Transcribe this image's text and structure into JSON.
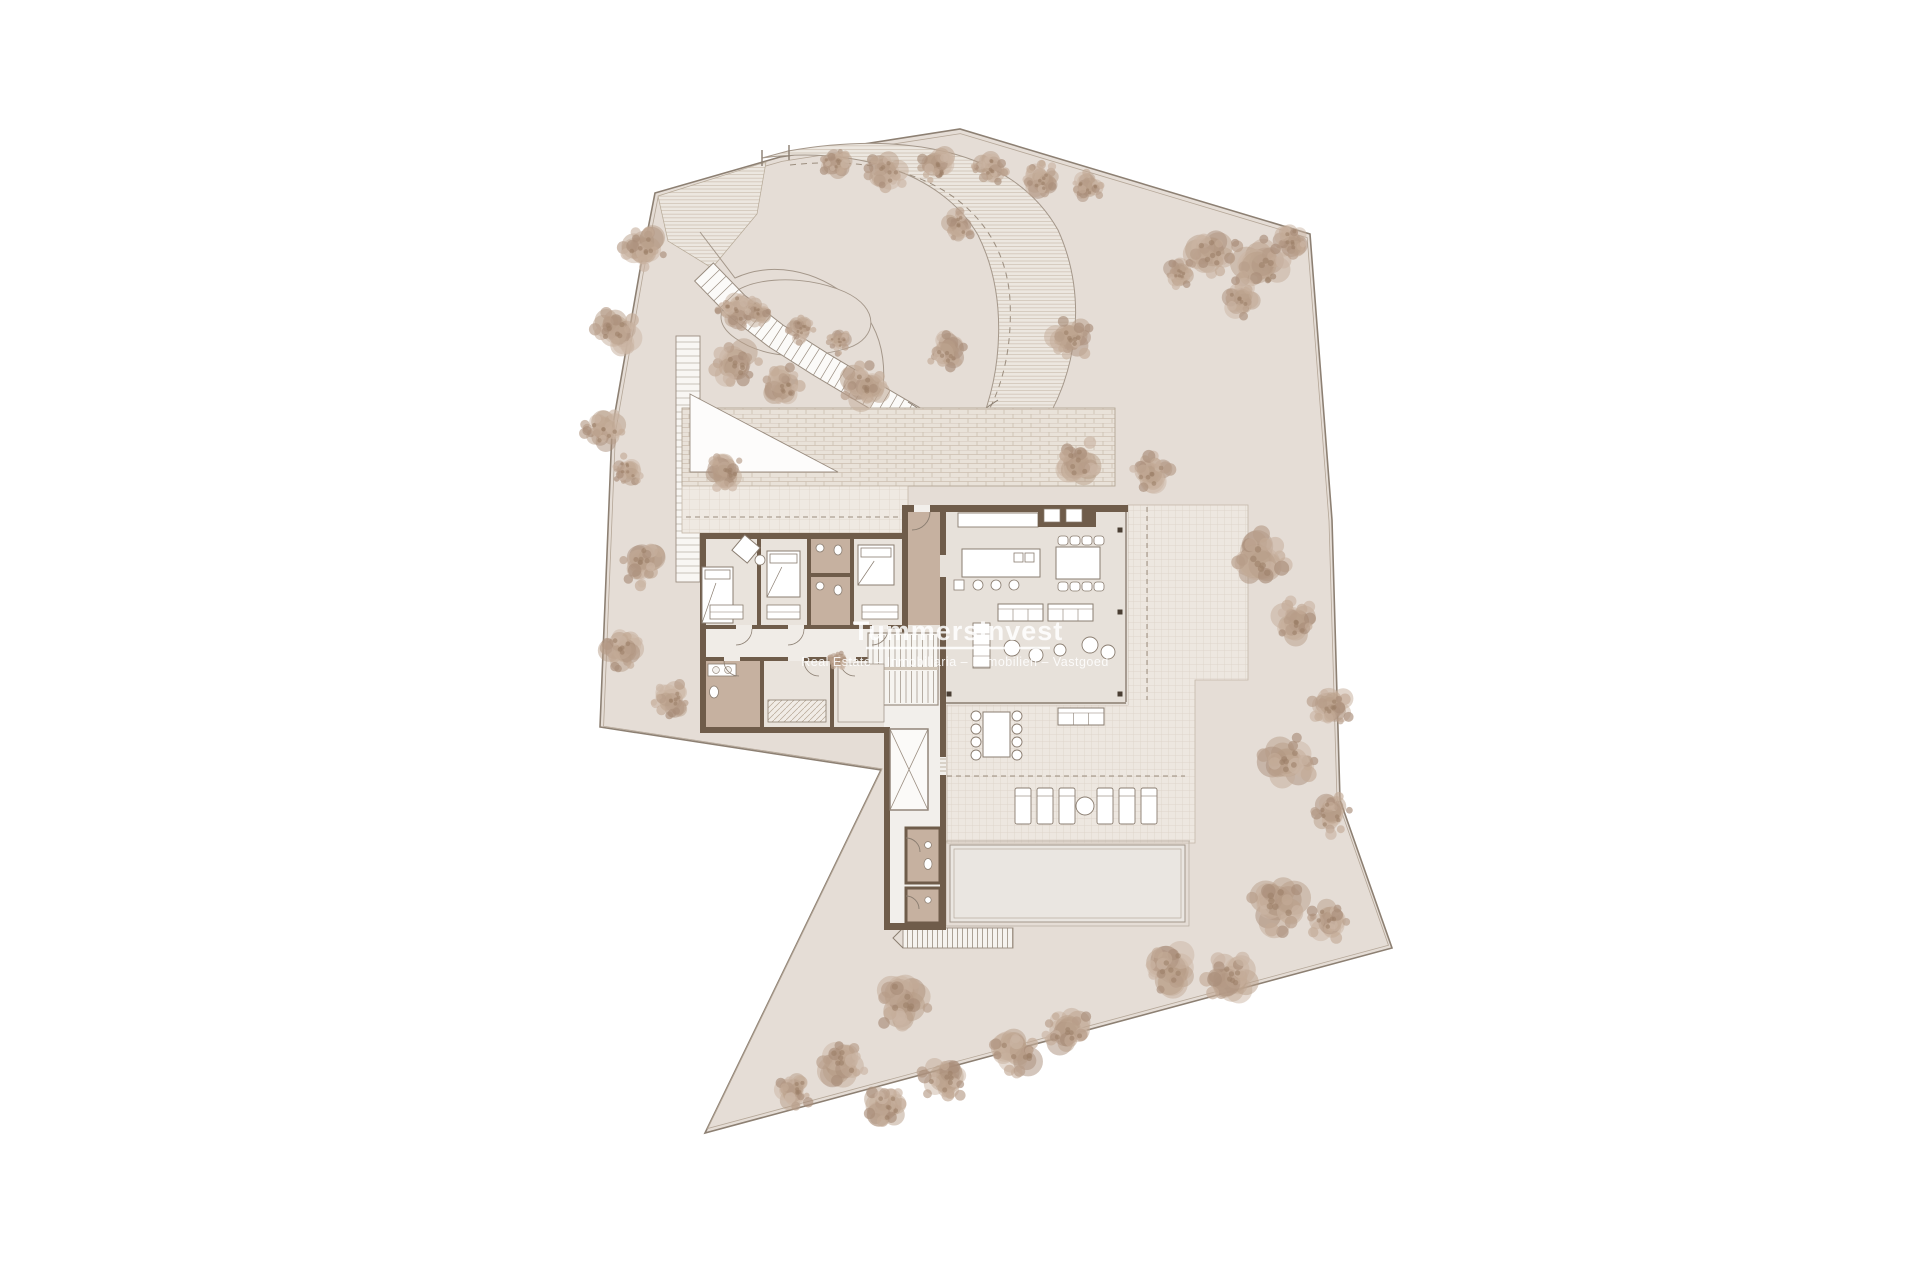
{
  "watermark": {
    "brand": "TummersInvest",
    "tagline": "Real Estate – Inmobiliaria – Immobilien – Vastgoed"
  },
  "drawing": {
    "kind": "architectural site plan / villa floor plan",
    "features": [
      "plot boundary",
      "curved driveway",
      "garden trees",
      "bedroom wing",
      "living-kitchen pavilion",
      "terrace",
      "sun loungers",
      "swimming pool",
      "staircase",
      "elevator"
    ]
  },
  "palette": {
    "paper": "#ffffff",
    "plot": "#e5ddd6",
    "plot_line": "#8d8073",
    "wall": "#6f5c4a",
    "bath_floor": "#c6b1a0",
    "room_floor": "#e9e3dc",
    "living_floor": "#e7e1da",
    "tile": "#ede7e0",
    "tile_line": "#d9cfc4",
    "brick": "#e9e2d9",
    "brick_line": "#ccbfb0",
    "hatch_fill": "#ece7e0",
    "hatch_line": "#d2c7ba",
    "pool": "#eae6e1",
    "pool_line": "#a2968a",
    "tree_1": "#c3ab97",
    "tree_2": "#b79d88",
    "tree_3": "#cbb6a4",
    "tree_4": "#a98e79",
    "dash_line": "#9b8d7e",
    "furniture_line": "#8a7d70",
    "furniture_fill": "#ffffff"
  }
}
